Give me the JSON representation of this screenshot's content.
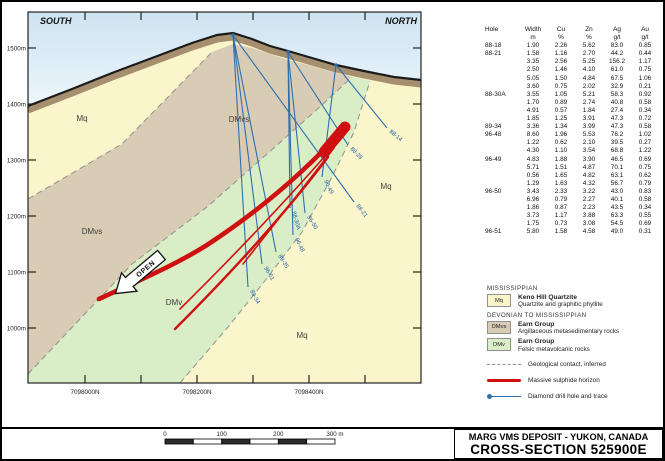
{
  "title_block": {
    "line1": "MARG VMS DEPOSIT - YUKON, CANADA",
    "line2": "CROSS-SECTION 525900E"
  },
  "colors": {
    "sky_top": "#cde3f1",
    "sky_bottom": "#eef6fb",
    "mq": "#fbf5cb",
    "dmvs": "#d8ccb4",
    "dmv": "#d9eec7",
    "surface_band": "#a68f6f",
    "surface_line": "#1b1b1b",
    "contact": "#8f8f8f",
    "drill": "#2e6fae",
    "sulphide": "#d01010",
    "frame": "#222222"
  },
  "section": {
    "south_label": "SOUTH",
    "north_label": "NORTH",
    "open_label": "OPEN",
    "elevations": [
      {
        "label": "1500m",
        "y": 46
      },
      {
        "label": "1400m",
        "y": 102
      },
      {
        "label": "1300m",
        "y": 158
      },
      {
        "label": "1200m",
        "y": 214
      },
      {
        "label": "1100m",
        "y": 270
      },
      {
        "label": "1000m",
        "y": 326
      }
    ],
    "northings": {
      "ticks_x": [
        83,
        139,
        195,
        251,
        307,
        363
      ],
      "labels": [
        {
          "text": "7098000N",
          "x": 83
        },
        {
          "text": "7098200N",
          "x": 195
        },
        {
          "text": "7098400N",
          "x": 307
        }
      ]
    },
    "unit_labels": [
      {
        "text": "Mq",
        "x": 80,
        "y": 119
      },
      {
        "text": "DMvs",
        "x": 237,
        "y": 120
      },
      {
        "text": "DMvs",
        "x": 90,
        "y": 232
      },
      {
        "text": "DMv",
        "x": 172,
        "y": 303
      },
      {
        "text": "Mq",
        "x": 384,
        "y": 187
      },
      {
        "text": "Mq",
        "x": 300,
        "y": 336
      }
    ],
    "collars": [
      {
        "x": 231,
        "y": 33
      },
      {
        "x": 286,
        "y": 50
      },
      {
        "x": 334,
        "y": 63
      }
    ],
    "drill_holes": [
      {
        "label": "89-34",
        "x1": 231,
        "y1": 33,
        "x2": 246,
        "y2": 285,
        "rot": 62
      },
      {
        "label": "96-51",
        "x1": 231,
        "y1": 33,
        "x2": 260,
        "y2": 262,
        "rot": 60
      },
      {
        "label": "89-35",
        "x1": 231,
        "y1": 33,
        "x2": 274,
        "y2": 250,
        "rot": 58
      },
      {
        "label": "88-21",
        "x1": 231,
        "y1": 33,
        "x2": 352,
        "y2": 200,
        "rot": 52
      },
      {
        "label": "88-30A",
        "x1": 286,
        "y1": 50,
        "x2": 288,
        "y2": 206,
        "rot": 74
      },
      {
        "label": "96-48",
        "x1": 286,
        "y1": 50,
        "x2": 291,
        "y2": 233,
        "rot": 64
      },
      {
        "label": "96-50",
        "x1": 286,
        "y1": 50,
        "x2": 303,
        "y2": 211,
        "rot": 58
      },
      {
        "label": "88-28",
        "x1": 286,
        "y1": 50,
        "x2": 346,
        "y2": 143,
        "rot": 46
      },
      {
        "label": "96-49",
        "x1": 334,
        "y1": 63,
        "x2": 320,
        "y2": 175,
        "rot": 64
      },
      {
        "label": "88-14",
        "x1": 334,
        "y1": 63,
        "x2": 385,
        "y2": 126,
        "rot": 40
      }
    ]
  },
  "scale_bar": {
    "x": 163,
    "y": 437,
    "length": 170,
    "segments": 6,
    "labels": [
      "0",
      "100",
      "200",
      "300 m"
    ]
  },
  "table": {
    "headers_row1": [
      "Hole",
      "Width",
      "Cu",
      "Zn",
      "Ag",
      "Au"
    ],
    "headers_row2": [
      "",
      "m",
      "%",
      "%",
      "g/t",
      "g/t"
    ],
    "rows": [
      [
        "88-18",
        "1.90",
        "2.26",
        "5.62",
        "83.0",
        "0.85"
      ],
      [
        "88-21",
        "1.58",
        "1.16",
        "2.70",
        "44.2",
        "0.44"
      ],
      [
        "",
        "3.35",
        "2.56",
        "5.25",
        "156.2",
        "1.17"
      ],
      [
        "",
        "2.50",
        "1.46",
        "4.10",
        "61.0",
        "0.75"
      ],
      [
        "",
        "5.05",
        "1.50",
        "4.84",
        "67.5",
        "1.06"
      ],
      [
        "",
        "3.60",
        "0.75",
        "2.02",
        "32.9",
        "0.21"
      ],
      [
        "88-30A",
        "3.55",
        "1.05",
        "5.21",
        "58.3",
        "0.92"
      ],
      [
        "",
        "1.70",
        "0.89",
        "2.74",
        "40.8",
        "0.58"
      ],
      [
        "",
        "4.91",
        "0.57",
        "1.84",
        "27.4",
        "0.34"
      ],
      [
        "",
        "1.85",
        "1.25",
        "3.91",
        "47.3",
        "0.72"
      ],
      [
        "89-34",
        "3.36",
        "1.34",
        "3.99",
        "47.3",
        "0.58"
      ],
      [
        "96-48",
        "8.60",
        "1.96",
        "5.53",
        "76.2",
        "1.02"
      ],
      [
        "",
        "1.22",
        "0.62",
        "2.10",
        "39.5",
        "0.27"
      ],
      [
        "",
        "4.30",
        "1.10",
        "3.54",
        "68.8",
        "1.22"
      ],
      [
        "96-49",
        "4.83",
        "1.88",
        "3.90",
        "46.5",
        "0.69"
      ],
      [
        "",
        "5.71",
        "1.51",
        "4.87",
        "70.1",
        "0.75"
      ],
      [
        "",
        "0.56",
        "1.65",
        "4.82",
        "63.1",
        "0.62"
      ],
      [
        "",
        "1.29",
        "1.63",
        "4.32",
        "56.7",
        "0.79"
      ],
      [
        "96-50",
        "3.43",
        "2.33",
        "3.22",
        "43.0",
        "0.83"
      ],
      [
        "",
        "6.96",
        "0.79",
        "2.27",
        "40.1",
        "0.58"
      ],
      [
        "",
        "1.86",
        "0.87",
        "2.23",
        "43.5",
        "0.34"
      ],
      [
        "",
        "3.73",
        "1.17",
        "3.88",
        "63.3",
        "0.55"
      ],
      [
        "",
        "1.75",
        "0.73",
        "3.08",
        "54.5",
        "0.69"
      ],
      [
        "96-51",
        "5.80",
        "1.58",
        "4.58",
        "49.0",
        "0.31"
      ]
    ]
  },
  "legend": {
    "groups": [
      {
        "title": "MISSISSIPPIAN",
        "items": [
          {
            "code": "Mq",
            "name": "Keno Hill Quartzite",
            "desc": "Quartzite and graphitic phyllite",
            "color_key": "mq"
          }
        ]
      },
      {
        "title": "DEVONIAN TO MISSISSIPPIAN",
        "items": [
          {
            "code": "DMvs",
            "name": "Earn Group",
            "desc": "Argillaceous metasedimentary rocks",
            "color_key": "dmvs"
          },
          {
            "code": "DMv",
            "name": "Earn Group",
            "desc": "Felsic metavolcanic rocks",
            "color_key": "dmv"
          }
        ]
      }
    ],
    "symbols": [
      {
        "type": "dashed",
        "label": "Geological contact, inferred"
      },
      {
        "type": "red-line",
        "label": "Massive sulphide horizon"
      },
      {
        "type": "drill",
        "label": "Diamond drill hole and trace"
      }
    ]
  }
}
